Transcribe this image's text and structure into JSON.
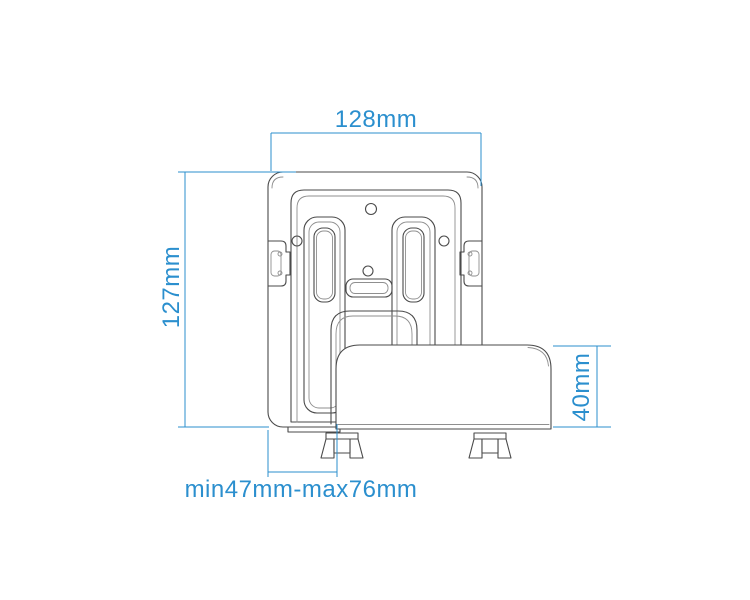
{
  "diagram": {
    "name": "wall-mount-bracket-dimension-drawing",
    "colors": {
      "background": "#ffffff",
      "drawing_line": "#4a4a4a",
      "drawing_line_light": "#8f8f8f",
      "dimension_accent": "#2b8fce"
    },
    "dimensions": {
      "width_label": "128mm",
      "height_label": "127mm",
      "holder_height_label": "40mm",
      "adjustable_range_label": "min47mm-max76mm"
    }
  }
}
